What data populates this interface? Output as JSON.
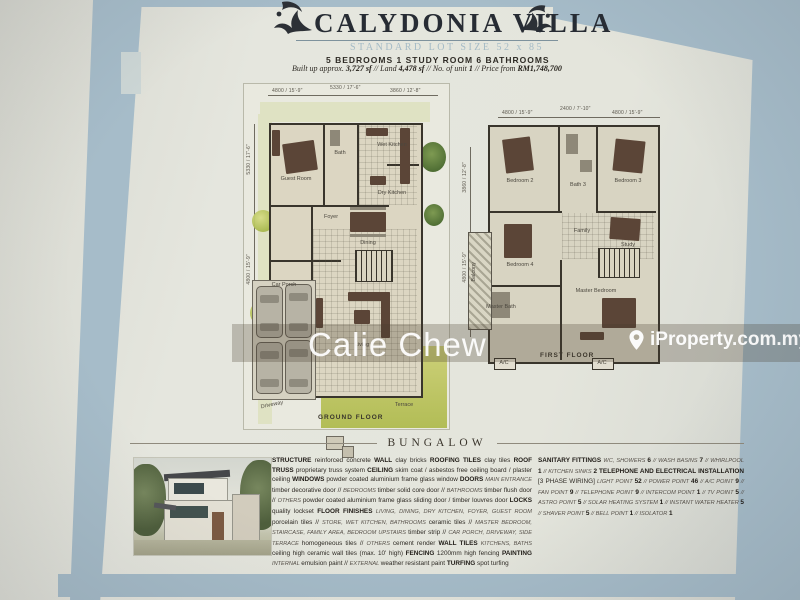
{
  "header": {
    "title": "CALYDONIA VILLA",
    "subtitle": "STANDARD LOT SIZE 52 x 85",
    "rooms_line": "5 BEDROOMS  1 STUDY ROOM  6 BATHROOMS",
    "details_segments": [
      {
        "c": "t",
        "s": "Built up approx. "
      },
      {
        "c": "n",
        "s": "3,727 sf"
      },
      {
        "c": "t",
        "s": " // Land "
      },
      {
        "c": "n",
        "s": "4,478 sf"
      },
      {
        "c": "t",
        "s": " // No. of unit "
      },
      {
        "c": "n",
        "s": "1"
      },
      {
        "c": "t",
        "s": " // Price from "
      },
      {
        "c": "n",
        "s": "RM1,748,700"
      }
    ]
  },
  "icons": {
    "flourish": "dragon-flourish-ornament",
    "pin": "location-pin"
  },
  "watermarks": {
    "agent": "Calie Chew",
    "portal": "iProperty.com.my"
  },
  "plans": {
    "ground": {
      "caption": "GROUND FLOOR",
      "dims": [
        "4800 / 15'-9\"",
        "5330 / 17'-6\"",
        "3860 / 12'-8\""
      ],
      "side_dims": [
        "5330 / 17'-6\"",
        "4800 / 15'-9\""
      ],
      "labels": {
        "guest_room": "Guest Room",
        "bath": "Bath",
        "wet_kitchen": "Wet Kitchen",
        "dry_kitchen": "Dry Kitchen",
        "foyer": "Foyer",
        "dining": "Dining",
        "living": "Living",
        "car_porch": "Car Porch",
        "driveway": "Driveway",
        "terrace": "Terrace"
      }
    },
    "first": {
      "caption": "FIRST FLOOR",
      "dims": [
        "4800 / 15'-9\"",
        "2400 / 7'-10\"",
        "4800 / 15'-9\""
      ],
      "side_dims": [
        "3860 / 12'-8\"",
        "4800 / 15'-9\""
      ],
      "ac_label": "A/C",
      "labels": {
        "bedroom_2": "Bedroom 2",
        "bath_3": "Bath 3",
        "bedroom_3": "Bedroom 3",
        "bedroom_4": "Bedroom 4",
        "family": "Family",
        "study": "Study",
        "master_bath": "Master Bath",
        "master_bedroom": "Master Bedroom",
        "balcony": "Balcony"
      }
    }
  },
  "section": {
    "heading": "BUNGALOW"
  },
  "specs": {
    "left_segments": [
      {
        "c": "k",
        "s": "STRUCTURE "
      },
      {
        "c": "t",
        "s": "reinforced concrete "
      },
      {
        "c": "k",
        "s": "WALL "
      },
      {
        "c": "t",
        "s": "clay bricks "
      },
      {
        "c": "k",
        "s": "ROOFING TILES "
      },
      {
        "c": "t",
        "s": "clay tiles "
      },
      {
        "c": "k",
        "s": "ROOF TRUSS "
      },
      {
        "c": "t",
        "s": "proprietary truss system "
      },
      {
        "c": "k",
        "s": "CEILING "
      },
      {
        "c": "t",
        "s": "skim coat / asbestos free ceiling board / plaster ceiling "
      },
      {
        "c": "k",
        "s": "WINDOWS "
      },
      {
        "c": "t",
        "s": "powder coated aluminium frame glass window "
      },
      {
        "c": "k",
        "s": "DOORS "
      },
      {
        "c": "s",
        "s": "MAIN ENTRANCE "
      },
      {
        "c": "t",
        "s": "timber decorative door // "
      },
      {
        "c": "s",
        "s": "BEDROOMS "
      },
      {
        "c": "t",
        "s": "timber solid core door // "
      },
      {
        "c": "s",
        "s": "BATHROOMS "
      },
      {
        "c": "t",
        "s": "timber flush door // "
      },
      {
        "c": "s",
        "s": "OTHERS "
      },
      {
        "c": "t",
        "s": "powder coated aluminium frame glass sliding door / timber louvres door "
      },
      {
        "c": "k",
        "s": "LOCKS "
      },
      {
        "c": "t",
        "s": "quality lockset "
      },
      {
        "c": "k",
        "s": "FLOOR FINISHES "
      },
      {
        "c": "s",
        "s": "LIVING, DINING, DRY KITCHEN, FOYER, GUEST ROOM "
      },
      {
        "c": "t",
        "s": "porcelain tiles // "
      },
      {
        "c": "s",
        "s": "STORE, WET KITCHEN, BATHROOMS "
      },
      {
        "c": "t",
        "s": "ceramic tiles // "
      },
      {
        "c": "s",
        "s": "MASTER BEDROOM, STAIRCASE, FAMILY AREA, BEDROOM UPSTAIRS "
      },
      {
        "c": "t",
        "s": "timber strip // "
      },
      {
        "c": "s",
        "s": "CAR PORCH, DRIVEWAY, SIDE TERRACE "
      },
      {
        "c": "t",
        "s": "homogeneous tiles // "
      },
      {
        "c": "s",
        "s": "OTHERS "
      },
      {
        "c": "t",
        "s": "cement render "
      },
      {
        "c": "k",
        "s": "WALL TILES "
      },
      {
        "c": "s",
        "s": "KITCHENS, BATHS "
      },
      {
        "c": "t",
        "s": "ceiling high ceramic wall tiles (max. 10' high) "
      },
      {
        "c": "k",
        "s": "FENCING "
      },
      {
        "c": "t",
        "s": "1200mm high fencing "
      },
      {
        "c": "k",
        "s": "PAINTING "
      },
      {
        "c": "s",
        "s": "INTERNAL "
      },
      {
        "c": "t",
        "s": "emulsion paint // "
      },
      {
        "c": "s",
        "s": "EXTERNAL "
      },
      {
        "c": "t",
        "s": "weather resistant paint "
      },
      {
        "c": "k",
        "s": "TURFING "
      },
      {
        "c": "t",
        "s": "spot turfing"
      }
    ],
    "right_segments": [
      {
        "c": "k",
        "s": "SANITARY FITTINGS "
      },
      {
        "c": "s",
        "s": "WC, SHOWERS "
      },
      {
        "c": "n",
        "s": "6"
      },
      {
        "c": "s",
        "s": " // WASH BASINS "
      },
      {
        "c": "n",
        "s": "7"
      },
      {
        "c": "s",
        "s": " // WHIRLPOOL "
      },
      {
        "c": "n",
        "s": "1"
      },
      {
        "c": "s",
        "s": " // KITCHEN SINKS "
      },
      {
        "c": "n",
        "s": "2 "
      },
      {
        "c": "k",
        "s": "TELEPHONE AND ELECTRICAL INSTALLATION "
      },
      {
        "c": "t",
        "s": "[3 PHASE WIRING] "
      },
      {
        "c": "s",
        "s": "LIGHT POINT "
      },
      {
        "c": "n",
        "s": "52"
      },
      {
        "c": "s",
        "s": " // POWER POINT "
      },
      {
        "c": "n",
        "s": "46"
      },
      {
        "c": "s",
        "s": " // A/C POINT "
      },
      {
        "c": "n",
        "s": "9"
      },
      {
        "c": "s",
        "s": " // FAN POINT "
      },
      {
        "c": "n",
        "s": "9"
      },
      {
        "c": "s",
        "s": " // TELEPHONE POINT "
      },
      {
        "c": "n",
        "s": "9"
      },
      {
        "c": "s",
        "s": " // INTERCOM POINT "
      },
      {
        "c": "n",
        "s": "1"
      },
      {
        "c": "s",
        "s": " // TV POINT "
      },
      {
        "c": "n",
        "s": "5"
      },
      {
        "c": "s",
        "s": " // ASTRO POINT "
      },
      {
        "c": "n",
        "s": "5"
      },
      {
        "c": "s",
        "s": " // SOLAR HEATING SYSTEM "
      },
      {
        "c": "n",
        "s": "1"
      },
      {
        "c": "s",
        "s": " // INSTANT WATER HEATER "
      },
      {
        "c": "n",
        "s": "5"
      },
      {
        "c": "s",
        "s": " // SHAVER POINT "
      },
      {
        "c": "n",
        "s": "5"
      },
      {
        "c": "s",
        "s": " // BELL POINT "
      },
      {
        "c": "n",
        "s": "1"
      },
      {
        "c": "s",
        "s": " // ISOLATOR "
      },
      {
        "c": "n",
        "s": "1"
      }
    ]
  }
}
